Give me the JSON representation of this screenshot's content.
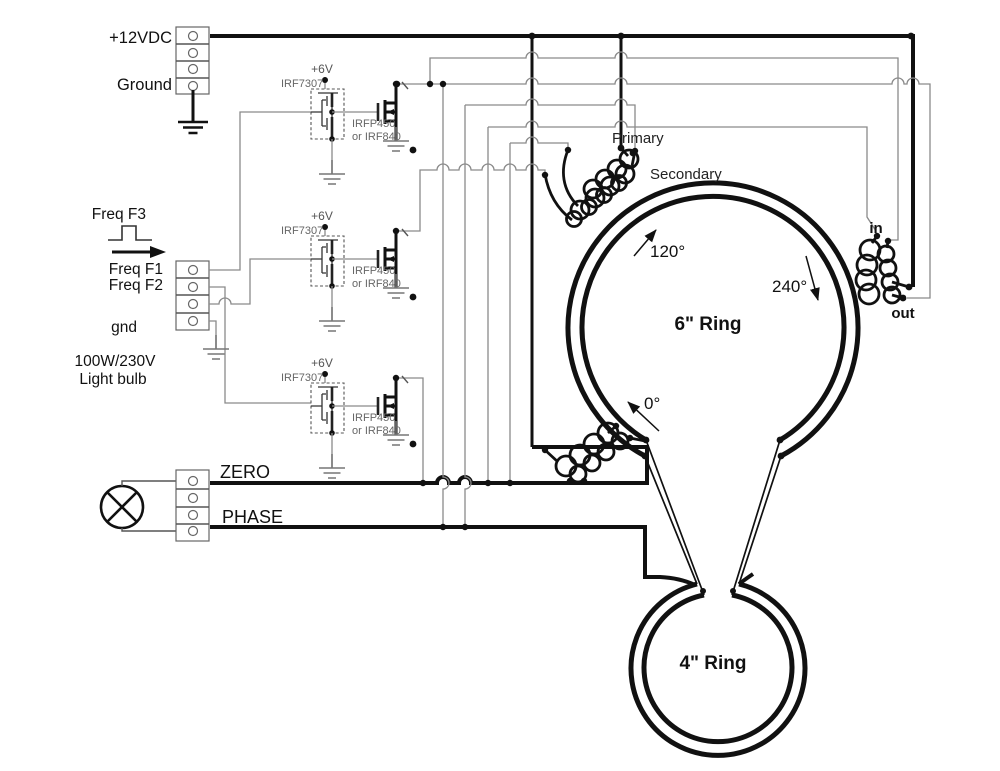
{
  "labels": {
    "supply": "+12VDC",
    "ground": "Ground",
    "freq_f3": "Freq F3",
    "freq_f1": "Freq F1",
    "freq_f2": "Freq F2",
    "gnd": "gnd",
    "load_power": "100W/230V",
    "load_name": "Light bulb",
    "zero": "ZERO",
    "phase": "PHASE",
    "primary": "Primary",
    "secondary": "Secondary",
    "coil_in": "in",
    "coil_out": "out",
    "angle_0": "0°",
    "angle_120": "120°",
    "angle_240": "240°",
    "ring6": "6\" Ring",
    "ring4": "4\" Ring"
  },
  "driver": {
    "vcc": "+6V",
    "ic": "IRF7307",
    "fet": "IRFP450",
    "fet_alt": "or IRF840"
  },
  "colors": {
    "background": "#ffffff",
    "wire_thin": "#8a8a8a",
    "wire_thick": "#111111",
    "label_gray": "#666666"
  }
}
